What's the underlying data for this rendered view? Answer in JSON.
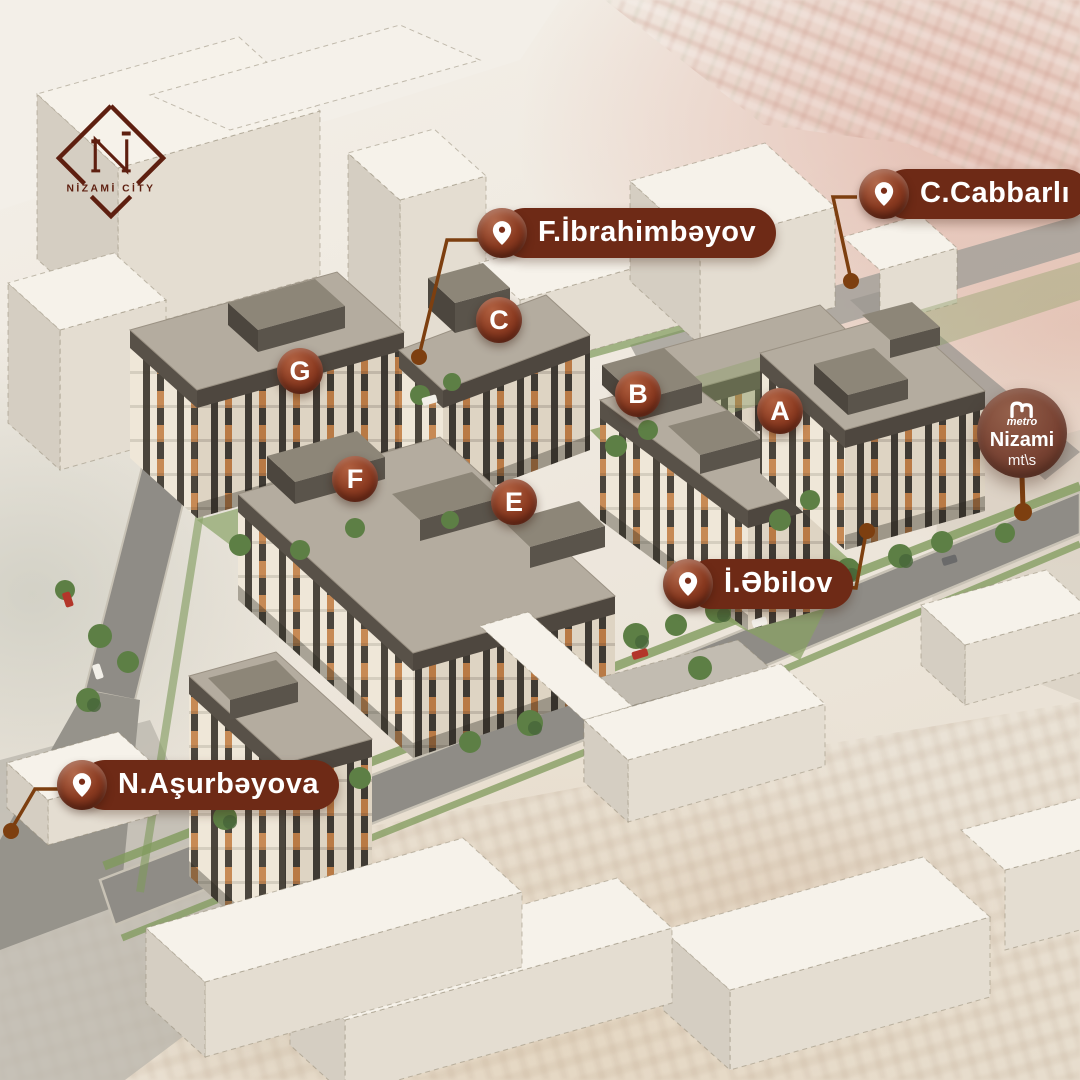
{
  "brand": {
    "logo_text": "NİZAMİ CİTY"
  },
  "map": {
    "street_labels": [
      {
        "id": "f-ibrahimbeyov",
        "name": "F.İbrahimbəyov"
      },
      {
        "id": "c-cabbarli",
        "name": "C.Cabbarlı"
      },
      {
        "id": "i-ebilov",
        "name": "İ.Əbilov"
      },
      {
        "id": "n-asurbeyova",
        "name": "N.Aşurbəyova"
      }
    ],
    "building_markers": [
      {
        "letter": "A"
      },
      {
        "letter": "B"
      },
      {
        "letter": "C"
      },
      {
        "letter": "E"
      },
      {
        "letter": "F"
      },
      {
        "letter": "G"
      }
    ],
    "metro": {
      "brand": "metro",
      "station": "Nizami",
      "type_suffix": "mt\\s"
    }
  },
  "colors": {
    "label_background": "#6e2a16",
    "marker_gradient_dark": "#641f0f",
    "connector_line": "#7d3f10",
    "metro_badge": "#7a4434",
    "logo_maroon": "#5e1f10"
  }
}
